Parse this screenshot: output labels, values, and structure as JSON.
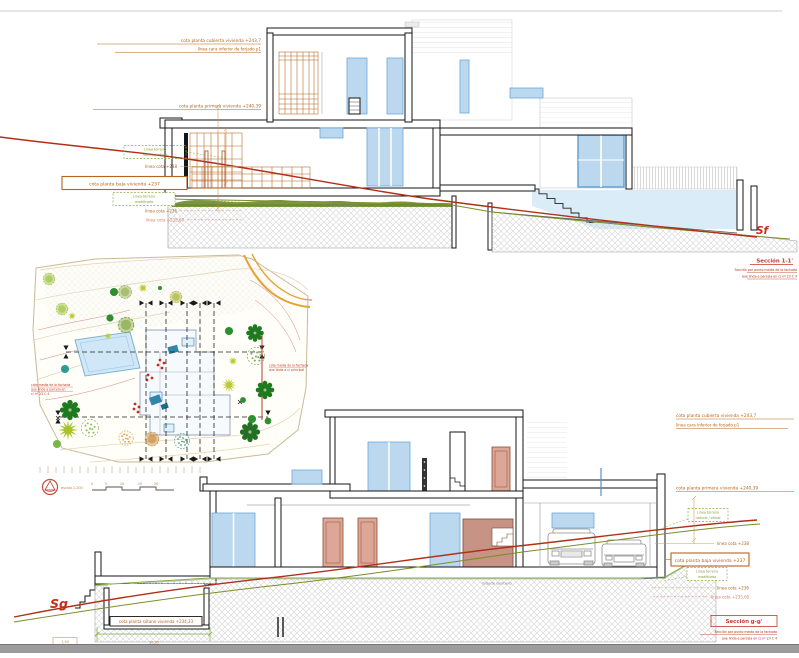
{
  "viewer": {
    "scrollbar": "horizontal"
  },
  "labels": {
    "cota_cubierta": "cota planta cubierta vivienda +243,7",
    "linea_forjado": "línea cara inferior de forjado p1",
    "cota_primera": "cota planta primera vivienda +240,39",
    "terreno_natural_l1": "Línea terreno",
    "terreno_natural_l2": "natural / oficial",
    "linea_238": "línea cota +238",
    "cota_baja": "cota planta baja vivienda +237",
    "terreno_mod_l1": "Línea terreno",
    "terreno_mod_l2": "modificado",
    "linea_236": "línea cota +236",
    "linea_23560": "línea cota +235,60",
    "cota_sotano": "cota planta sótano vivienda +234,33",
    "forjado": "forjado sanitario"
  },
  "section_f": {
    "marker": "Sf",
    "title": "Sección 1-1'",
    "note1": "Sección por punto medio de la fachada",
    "note2": "que linda a parcela en c/ nº 23 C 4"
  },
  "section_g": {
    "marker": "Sg",
    "title": "Sección g-g'",
    "note1": "Sección por punto medio de la fachada",
    "note2": "que linda a parcela en c/ nº 23 C 4",
    "dim_box": "1,50",
    "dim_value": "10,35"
  },
  "site_plan": {
    "scale": "escala 1:200",
    "scale_ticks": [
      "0",
      "5",
      "10",
      "15",
      "20"
    ],
    "note_left_l1": "cota media de la fachada",
    "note_left_l2": "que linda a parcela en",
    "note_left_l3": "c/ nº 23 C 4",
    "note_right_l1": "cota media de la fachada",
    "note_right_l2": "que linda a c/ principal"
  },
  "colors": {
    "annotation_orange": "#b5651d",
    "terrain_red": "#b03018",
    "terrain_olive": "#7d8c28",
    "dim_green": "#7fae3a",
    "glazing_blue": "#bcd8ef",
    "door_salmon": "#dca796",
    "pool_blue": "#d9ecf7",
    "title_red": "#c0392b"
  }
}
